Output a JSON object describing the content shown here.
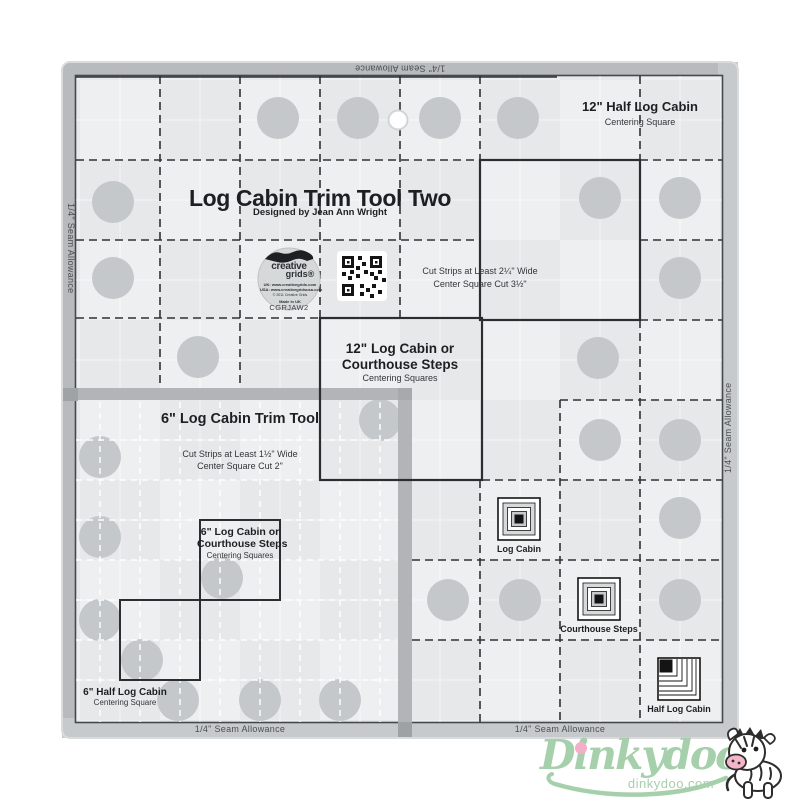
{
  "ruler": {
    "title": "Log Cabin Trim Tool Two",
    "subtitle": "Designed by Jean Ann Wright",
    "product_code": "CGRJAW2",
    "seam_allowance": "1/4\" Seam Allowance",
    "brand": {
      "name_top": "creative",
      "name_bottom": "grids®",
      "url_uk": "UK: www.creativegrids.com",
      "url_usa": "USA: www.creativegridsusa.com",
      "copyright": "© 2011 Creative Grids",
      "origin": "Made in UK"
    },
    "sections": {
      "half_log_cabin_12": {
        "title": "12\" Half Log Cabin",
        "subtitle": "Centering Square"
      },
      "cut_12": {
        "line1": "Cut Strips at Least 2¼\" Wide",
        "line2": "Center Square Cut 3½\""
      },
      "log_cabin_12": {
        "line1": "12\" Log Cabin or",
        "line2": "Courthouse Steps",
        "subtitle": "Centering Squares"
      },
      "tool_6": {
        "title": "6\" Log Cabin Trim Tool",
        "cut_line1": "Cut Strips at Least 1½\" Wide",
        "cut_line2": "Center Square Cut 2\""
      },
      "log_cabin_6": {
        "line1": "6\" Log Cabin or",
        "line2": "Courthouse Steps",
        "subtitle": "Centering Squares"
      },
      "half_log_cabin_6": {
        "title": "6\" Half Log Cabin",
        "subtitle": "Centering Square"
      }
    },
    "block_labels": {
      "log_cabin": "Log Cabin",
      "courthouse_steps": "Courthouse Steps",
      "half_log_cabin": "Half Log Cabin"
    }
  },
  "footer": {
    "brand": "Dinkydoo",
    "website": "dinkydoo.com"
  },
  "colors": {
    "logo_green": "#a6cfab",
    "logo_pink": "#f2afc7",
    "ruler_frame": "#b7bbbd",
    "ruler_surface": "#e6e8e9",
    "grip_dot": "#c4c8ca"
  }
}
